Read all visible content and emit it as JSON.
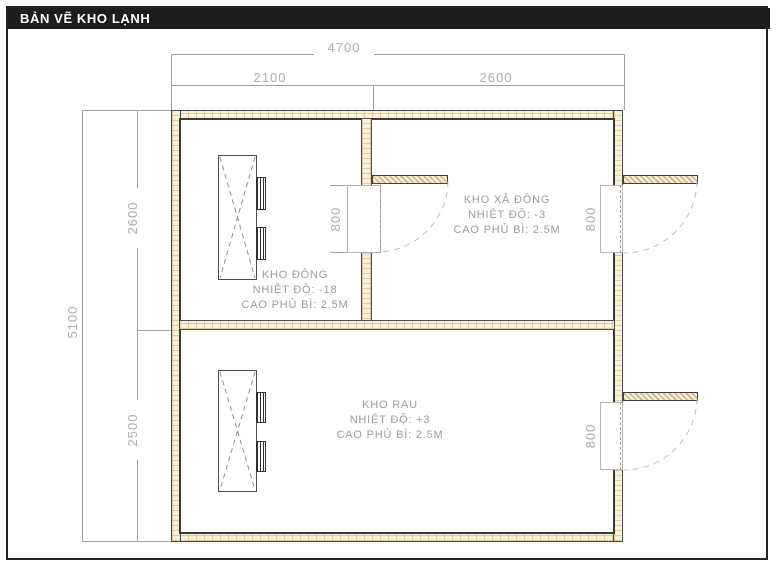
{
  "title": "BẢN VẼ KHO LẠNH",
  "rooms": [
    {
      "name": "KHO ĐÔNG",
      "temperature": "NHIỆT ĐỘ: -18",
      "clearance": "CAO PHỦ BÌ: 2.5M"
    },
    {
      "name": "KHO XẢ ĐÔNG",
      "temperature": "NHIỆT ĐỘ: -3",
      "clearance": "CAO PHỦ BÌ: 2.5M"
    },
    {
      "name": "KHO RAU",
      "temperature": "NHIỆT ĐỘ: +3",
      "clearance": "CAO PHỦ BÌ: 2.5M"
    }
  ],
  "dimensions": {
    "overall_width": "4700",
    "width_left": "2100",
    "width_right": "2600",
    "overall_height": "5100",
    "height_top": "2600",
    "height_bottom": "2500"
  },
  "doors": [
    {
      "width": "800"
    },
    {
      "width": "800"
    },
    {
      "width": "800"
    }
  ],
  "colors": {
    "titlebar_bg": "#1d1d1d",
    "titlebar_text": "#ffffff",
    "wall_fill": "#f7f0da",
    "wall_hatch": "#c7a969",
    "dimension_line": "#a3a3a3",
    "label_text": "#9c9c9c"
  }
}
